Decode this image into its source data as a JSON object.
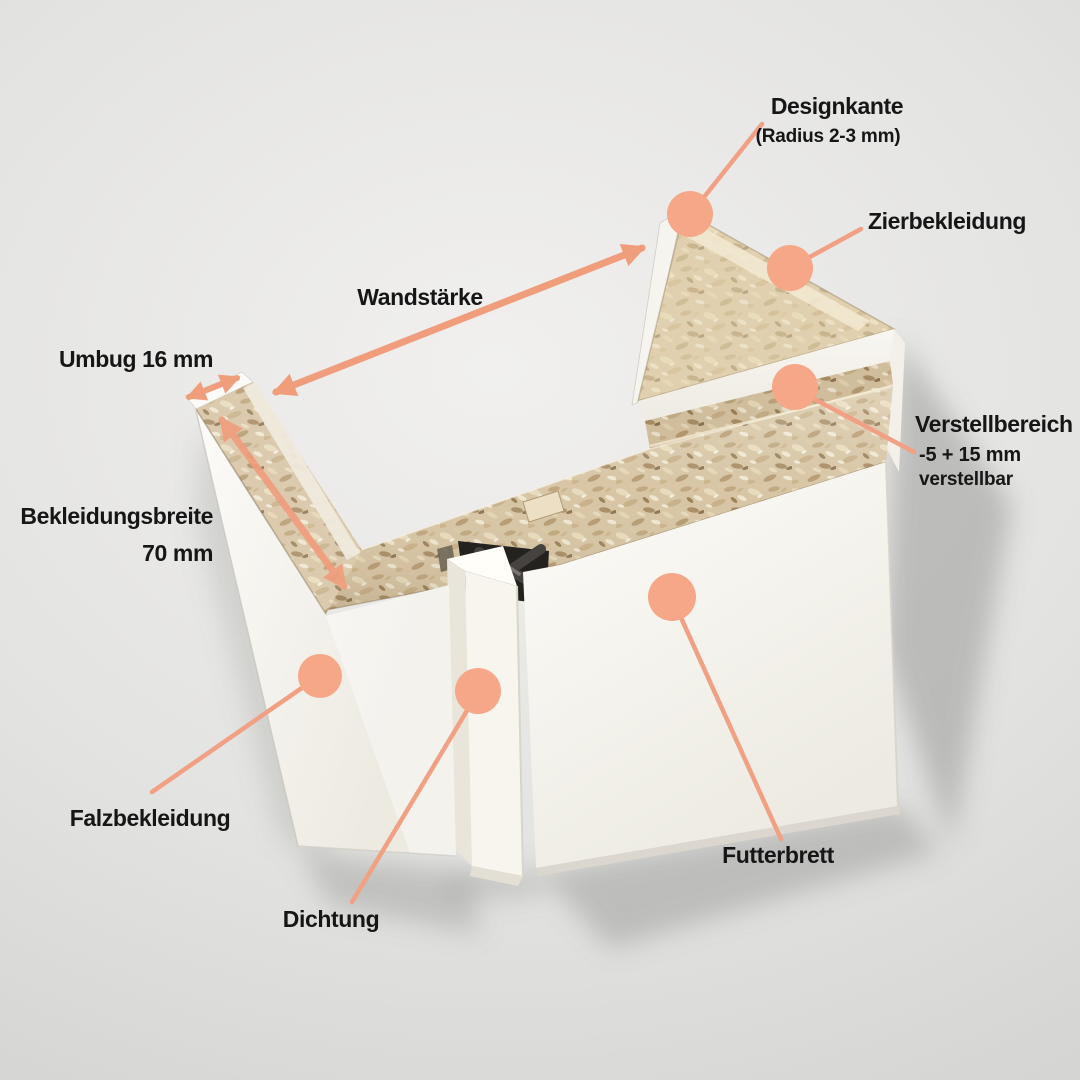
{
  "annotations": {
    "designkante": {
      "label": "Designkante",
      "sublabel": "(Radius 2-3 mm)"
    },
    "zierbekleidung": {
      "label": "Zierbekleidung"
    },
    "wandstaerke": {
      "label": "Wandstärke"
    },
    "umbug": {
      "label": "Umbug 16 mm"
    },
    "bekleidungsbreite": {
      "label": "Bekleidungsbreite",
      "value": "70 mm"
    },
    "verstellbereich": {
      "label": "Verstellbereich",
      "subline1": "-5 + 15 mm",
      "subline2": "verstellbar"
    },
    "falzbekleidung": {
      "label": "Falzbekleidung"
    },
    "dichtung": {
      "label": "Dichtung"
    },
    "futterbrett": {
      "label": "Futterbrett"
    }
  },
  "colors": {
    "marker": "#f5a787",
    "leader_line": "#f1a084",
    "arrow": "#f09d7c",
    "label_text": "#161616",
    "background_center": "#f1f0ee",
    "background_edge": "#d2d2d0",
    "chipboard": "#d7c5a4",
    "panel_white": "#f8f5ef",
    "seal_dark": "#23221f"
  }
}
